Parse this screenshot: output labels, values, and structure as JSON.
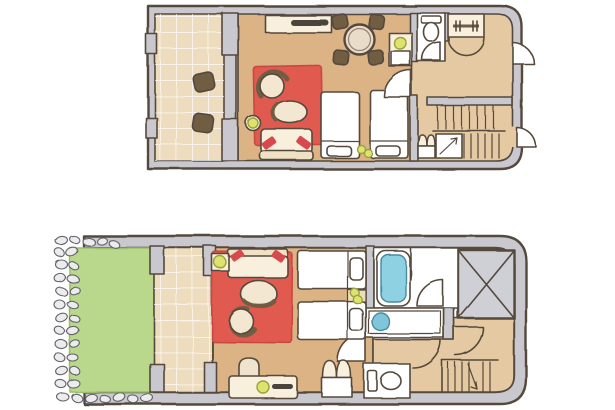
{
  "illustration": {
    "type": "hand-drawn architectural floor plan, two levels, no text labels",
    "floors": [
      {
        "id": "upper-floor",
        "position": "top",
        "rooms": [
          {
            "name": "terrace",
            "furniture": [
              "floor-cushion",
              "floor-cushion"
            ]
          },
          {
            "name": "living-dining-room",
            "furniture": [
              "sideboard-with-tv",
              "round-dining-table",
              "dining-chair",
              "dining-chair",
              "dining-chair",
              "dining-chair",
              "cabinet-with-lamp",
              "red-rug",
              "armchair",
              "armchair",
              "floor-lamp",
              "sofa-with-red-cushions",
              "twin-bed",
              "twin-bed",
              "nightstand-lamps"
            ]
          },
          {
            "name": "wc",
            "furniture": [
              "toilet"
            ]
          },
          {
            "name": "entrance-hall",
            "furniture": [
              "wardrobe-rail",
              "hall-closet",
              "understair-storage"
            ]
          },
          {
            "name": "staircase",
            "furniture": [
              "stairs",
              "direction-arrow"
            ]
          }
        ],
        "doors": [
          "entrance-door",
          "side-door",
          "living-room-door",
          "wc-door"
        ]
      },
      {
        "id": "lower-floor",
        "position": "bottom",
        "rooms": [
          {
            "name": "garden",
            "furniture": [
              "lawn",
              "pebble-border"
            ]
          },
          {
            "name": "terrace",
            "furniture": []
          },
          {
            "name": "bedroom-living-area",
            "furniture": [
              "sofa-with-red-cushions",
              "side-table-lamp",
              "red-rug",
              "armchair",
              "armchair",
              "desk",
              "desk-chair",
              "desk-lamp",
              "twin-bed",
              "twin-bed",
              "nightstand-with-lamps",
              "double-door-closet"
            ]
          },
          {
            "name": "bathroom",
            "furniture": [
              "bathtub",
              "vanity-sink"
            ]
          },
          {
            "name": "wc",
            "furniture": [
              "toilet"
            ]
          },
          {
            "name": "hallway",
            "furniture": []
          },
          {
            "name": "staircase",
            "furniture": [
              "stairs",
              "direction-arrow"
            ]
          },
          {
            "name": "shaft",
            "furniture": [
              "crossed-box"
            ]
          }
        ],
        "doors": [
          "bathroom-door",
          "bedroom-door",
          "hallway-door",
          "hallway-door"
        ]
      }
    ]
  },
  "colors": {
    "ink": "#54493c",
    "wall_gray": "#c9c8ce",
    "floor_wood": "#dcb384",
    "floor_hall": "#e4c9a2",
    "floor_tile": "#eedcbf",
    "room_white": "#ffffff",
    "rug_red": "#e05a50",
    "rug_edge": "#c84a43",
    "furniture_cream": "#f8efdd",
    "furniture_beige": "#f3e7d2",
    "sofa_back": "#f0e0c4",
    "cushion_red": "#d84a4e",
    "wood_brown": "#6f5d42",
    "dark_accent": "#4a443e",
    "lamp_yellow": "#dde36e",
    "lamp_stroke": "#9aa23c",
    "tub_blue": "#8ed1e3",
    "tub_stroke": "#4a8aa0",
    "sink_blue": "#7fc6db",
    "lawn_green": "#b9d88c",
    "lawn_edge": "#9cbc6e",
    "pebble_fill": "#ececef",
    "pebble_stroke": "#63636a",
    "shaft_gray": "#ced0d6",
    "table_top": "#e9dcc8",
    "nightstand_tan": "#efdcbc"
  }
}
